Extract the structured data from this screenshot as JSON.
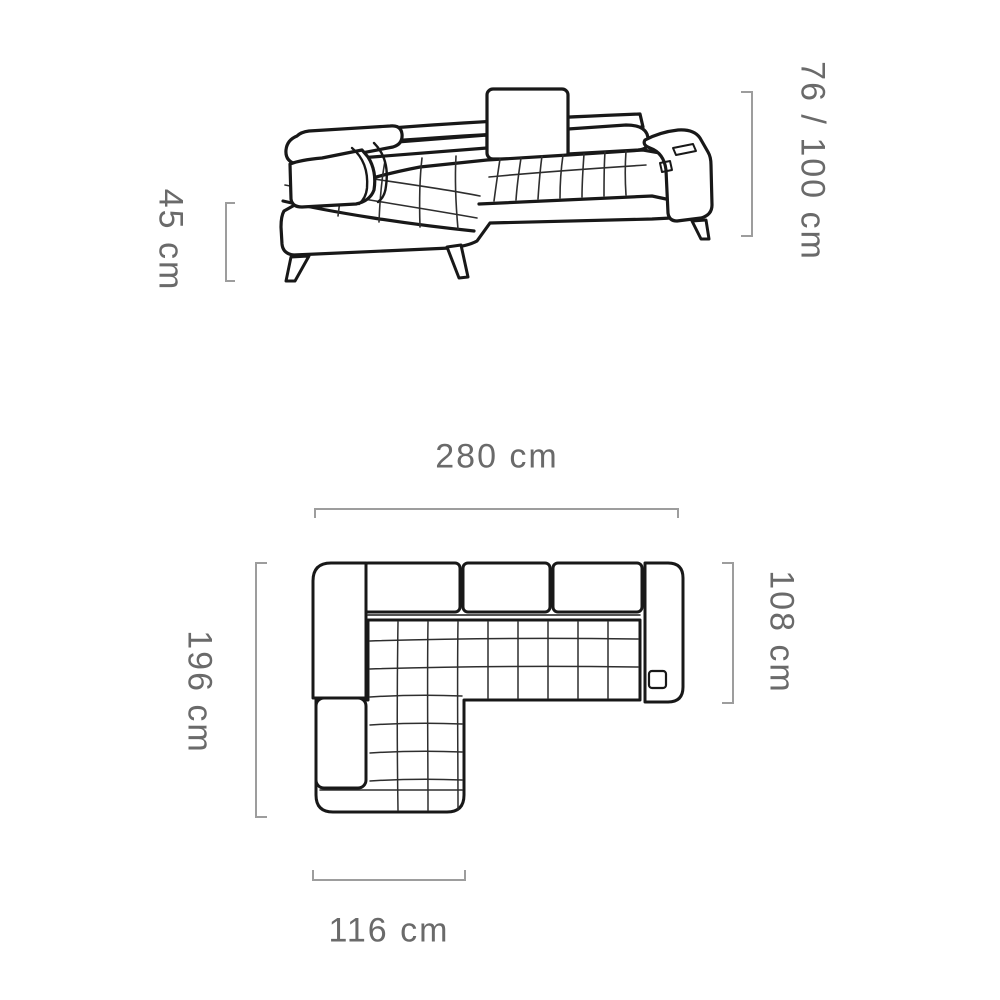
{
  "dimensions": {
    "seat_height": {
      "label": "45 cm"
    },
    "back_height": {
      "label": "76 / 100 cm"
    },
    "total_width": {
      "label": "280 cm"
    },
    "total_depth": {
      "label": "196 cm"
    },
    "right_section_depth": {
      "label": "108 cm"
    },
    "chaise_width": {
      "label": "116 cm"
    }
  },
  "colors": {
    "sofa_outline": "#181818",
    "quilting": "#2e2e2e",
    "dimension_line": "#9d9d9d",
    "dimension_text": "#6a6a6a",
    "background": "#ffffff"
  }
}
